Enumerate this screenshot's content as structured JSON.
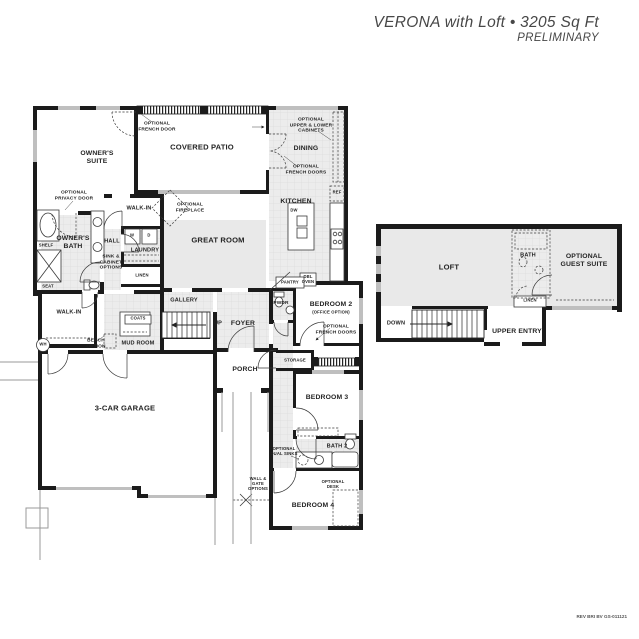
{
  "header": {
    "title": "VERONA with Loft • 3205 Sq Ft",
    "subtitle": "PRELIMINARY"
  },
  "footer": {
    "revision": "REV BRI BV GS-011121"
  },
  "colors": {
    "wall": "#1b1b1b",
    "room_gray": "#e9e9e9",
    "tile_line": "#dcdcdc",
    "window": "#bfbfbf",
    "text": "#242424",
    "title": "#474747"
  },
  "labels": {
    "owners_suite": "OWNER'S\nSUITE",
    "optional_french_door": "OPTIONAL\nFRENCH DOOR",
    "covered_patio": "COVERED PATIO",
    "optional_upper_lower_cabinets": "OPTIONAL\nUPPER & LOWER\nCABINETS",
    "dining": "DINING",
    "optional_french_doors_dining": "OPTIONAL\nFRENCH DOORS",
    "optional_privacy_door": "OPTIONAL\nPRIVACY DOOR",
    "walk_in_owner": "WALK-IN",
    "optional_fireplace": "OPTIONAL\nFIREPLACE",
    "kitchen": "KITCHEN",
    "ref": "REF",
    "dw": "DW",
    "owners_bath": "OWNER'S\nBATH",
    "shelf": "SHELF",
    "hall": "HALL",
    "washer": "W",
    "dryer": "D",
    "laundry": "LAUNDRY",
    "sink_cabinet_options": "SINK &\nCABINET\nOPTIONS",
    "great_room": "GREAT ROOM",
    "seat": "SEAT",
    "linen_main": "LINEN",
    "walk_in_mud": "WALK-IN",
    "gallery": "GALLERY",
    "coats": "COATS",
    "up": "UP",
    "foyer": "FOYER",
    "pwdr": "PWDR",
    "pantry": "PANTRY",
    "dbl_oven": "DBL\nOVEN",
    "bedroom2": "BEDROOM 2",
    "office_option": "(OFFICE OPTION)",
    "optional_french_doors_bedroom2": "OPTIONAL\nFRENCH DOORS",
    "bench_option": "BENCH\nOPTION",
    "mud_room": "MUD ROOM",
    "storage": "STORAGE",
    "porch": "PORCH",
    "garage": "3-CAR GARAGE",
    "bedroom3": "BEDROOM 3",
    "optional_dual_sinks": "OPTIONAL\nDUAL SINKS",
    "bath2": "BATH 2",
    "wall_gate_options": "WALL &\nGATE\nOPTIONS",
    "optional_desk": "OPTIONAL\nDESK",
    "bedroom4": "BEDROOM 4",
    "wh": "WH",
    "loft": "LOFT",
    "bath_loft": "BATH",
    "optional_guest_suite": "OPTIONAL\nGUEST SUITE",
    "linen_loft": "LINEN",
    "down": "DOWN",
    "upper_entry": "UPPER ENTRY"
  }
}
